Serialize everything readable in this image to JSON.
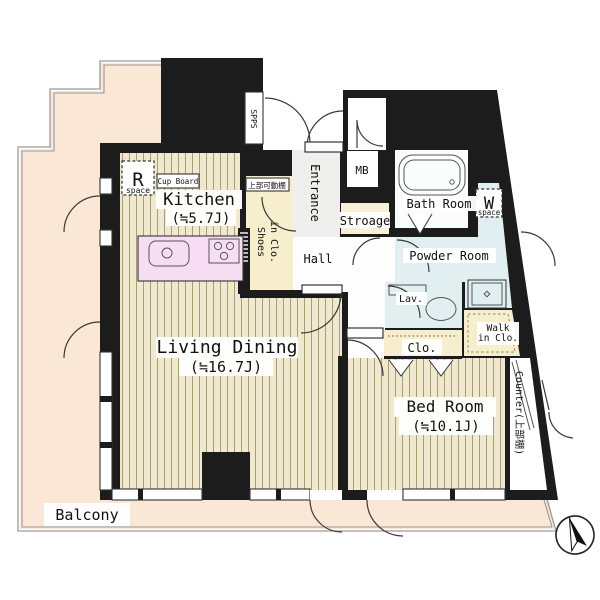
{
  "title": "apartment floor plan",
  "rooms": {
    "kitchen": {
      "name": "Kitchen",
      "size": "(≒5.7J)"
    },
    "living": {
      "name": "Living Dining",
      "size": "(≒16.7J)"
    },
    "bedroom": {
      "name": "Bed Room",
      "size": "(≒10.1J)"
    },
    "balcony": {
      "name": "Balcony"
    },
    "entrance": {
      "name": "Entrance"
    },
    "hall": {
      "name": "Hall"
    },
    "bath": {
      "name": "Bath Room"
    },
    "powder": {
      "name": "Powder Room"
    },
    "lav": {
      "name": "Lav."
    },
    "storage": {
      "name": "Stroage"
    },
    "mb": {
      "name": "MB"
    },
    "closet": {
      "name": "Clo."
    },
    "walk_in_closet": {
      "line1": "Walk",
      "line2": "in Clo."
    },
    "shoes_closet": {
      "line1": "Shoes",
      "line2": "in Clo."
    },
    "counter": {
      "name": "Counter(上部棚)"
    },
    "spps": {
      "name": "SPPS"
    }
  },
  "fixtures": {
    "r_space": {
      "letter": "R",
      "sub": "space"
    },
    "w_space": {
      "letter": "W",
      "sub": "space"
    },
    "cupboard": {
      "label": "Cup Board"
    },
    "upper_shelf": {
      "label": "上部可動棚"
    }
  },
  "colors": {
    "wall": "#1c1c1c",
    "balcony_floor": "#fbe7d6",
    "flooring_base": "#f0e9cf",
    "flooring_stripe": "#a89e74",
    "kitchen_counter": "#f6ddf4",
    "water_blue": "#e2eff1",
    "cream": "#f6eecd",
    "storage_cream": "#f8f1d8",
    "entrance_gray": "#efefed",
    "white": "#ffffff",
    "railing_gray": "#9a9a9a"
  }
}
